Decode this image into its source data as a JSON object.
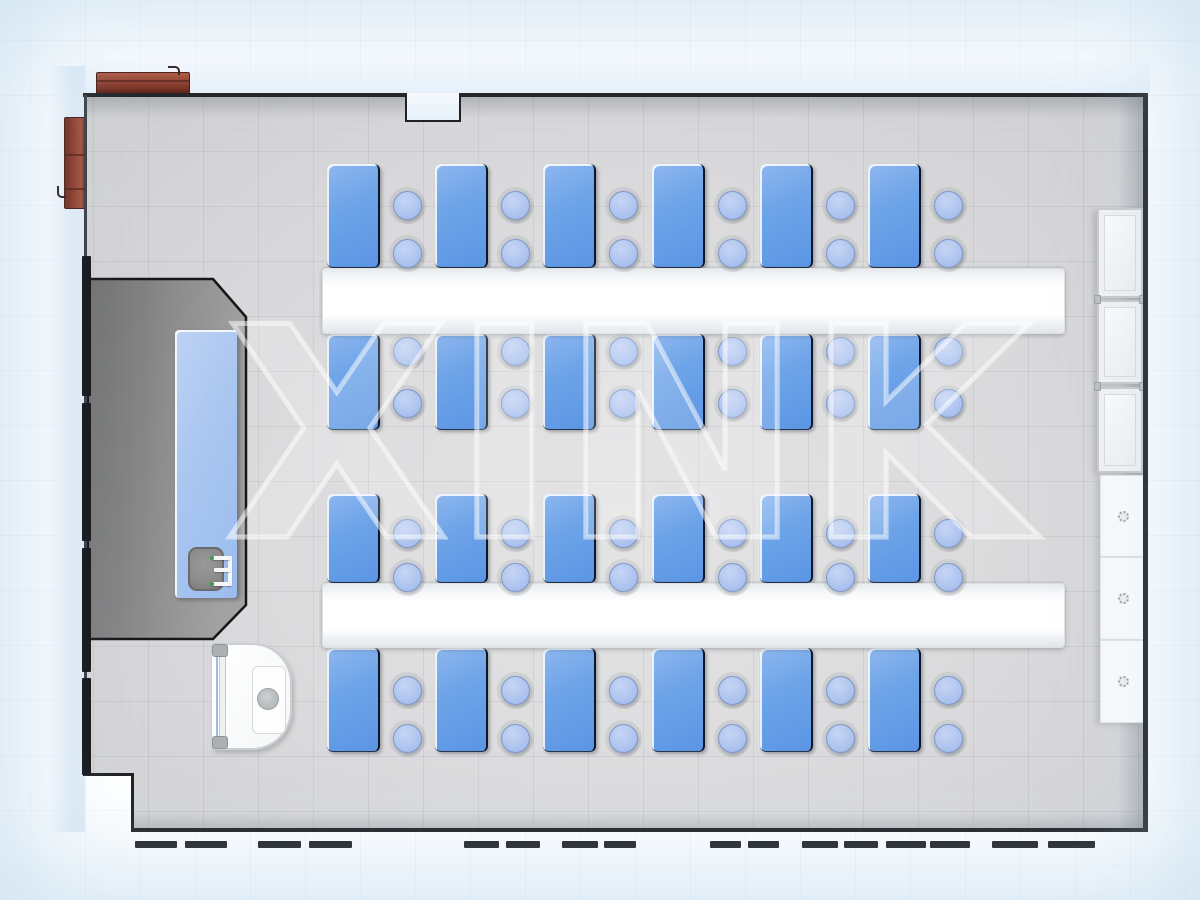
{
  "watermark": {
    "text": "XINK"
  },
  "room": {
    "walls": {
      "top_left_seg": {
        "x": 83,
        "y": 93,
        "w": 325,
        "h": 3.5
      },
      "top_right_seg": {
        "x": 458,
        "y": 93,
        "w": 689,
        "h": 3.5
      },
      "right": {
        "x": 1143,
        "y": 93,
        "w": 5,
        "h": 739
      },
      "bottom": {
        "x": 131,
        "y": 828,
        "w": 1016,
        "h": 4
      },
      "step_v": {
        "x": 131,
        "y": 775,
        "w": 3,
        "h": 55
      },
      "step_h": {
        "x": 83,
        "y": 773,
        "w": 51,
        "h": 3
      },
      "left_thin": {
        "x": 84,
        "y": 95,
        "w": 3,
        "h": 680
      }
    },
    "left_wall_segments": [
      [
        256,
        140
      ],
      [
        403,
        138
      ],
      [
        548,
        124
      ],
      [
        678,
        97
      ]
    ],
    "notch": {
      "x": 405,
      "y": 93,
      "w": 56,
      "h": 29
    }
  },
  "workstations": {
    "desk_columns": [
      327,
      435,
      543,
      652,
      760,
      868
    ],
    "desk_w": 53,
    "stool": {
      "dx": 80,
      "d": 29
    },
    "assemblies": [
      {
        "band": {
          "x": 322,
          "y": 268,
          "w": 743,
          "h": 66
        },
        "rows": [
          {
            "y": 164,
            "h": 104,
            "stool_cys": [
              205,
              253
            ]
          },
          {
            "y": 334,
            "h": 96,
            "stool_cys": [
              351,
              403
            ]
          }
        ]
      },
      {
        "band": {
          "x": 322,
          "y": 583,
          "w": 743,
          "h": 65
        },
        "rows": [
          {
            "y": 494,
            "h": 89,
            "stool_cys": [
              533,
              577
            ]
          },
          {
            "y": 648,
            "h": 104,
            "stool_cys": [
              690,
              738
            ]
          }
        ]
      }
    ]
  },
  "cabinets_right": {
    "glass": {
      "x": 1097,
      "w": 46,
      "units": [
        [
          208,
          90
        ],
        [
          300,
          84
        ],
        [
          387,
          86
        ]
      ]
    },
    "base": {
      "x": 1100,
      "w": 44,
      "units": [
        [
          475,
          82
        ],
        [
          557,
          83
        ],
        [
          640,
          83
        ]
      ],
      "knob_cx": 1123,
      "knob_cys": [
        516,
        598,
        681
      ]
    }
  },
  "windows": {
    "dash_y": 841,
    "dashes": [
      [
        135,
        42
      ],
      [
        185,
        42
      ],
      [
        258,
        43
      ],
      [
        309,
        43
      ],
      [
        464,
        35
      ],
      [
        506,
        34
      ],
      [
        562,
        36
      ],
      [
        604,
        32
      ],
      [
        710,
        31
      ],
      [
        748,
        31
      ],
      [
        802,
        36
      ],
      [
        844,
        34
      ],
      [
        886,
        40
      ],
      [
        930,
        40
      ],
      [
        992,
        46
      ],
      [
        1048,
        47
      ]
    ]
  },
  "colors": {
    "desk_blue": "#6ea4e8",
    "stool_blue": "#aec4ef",
    "bench_white": "#ffffff",
    "floor_gray": "#d9dadc",
    "platform_gray": "#8a8a8a",
    "wall_dark": "#1e1f21",
    "cabinet_brown": "#8f3a28",
    "teacher_desk_blue": "#a9c6f0",
    "outside_blue": "#e2edf8"
  }
}
